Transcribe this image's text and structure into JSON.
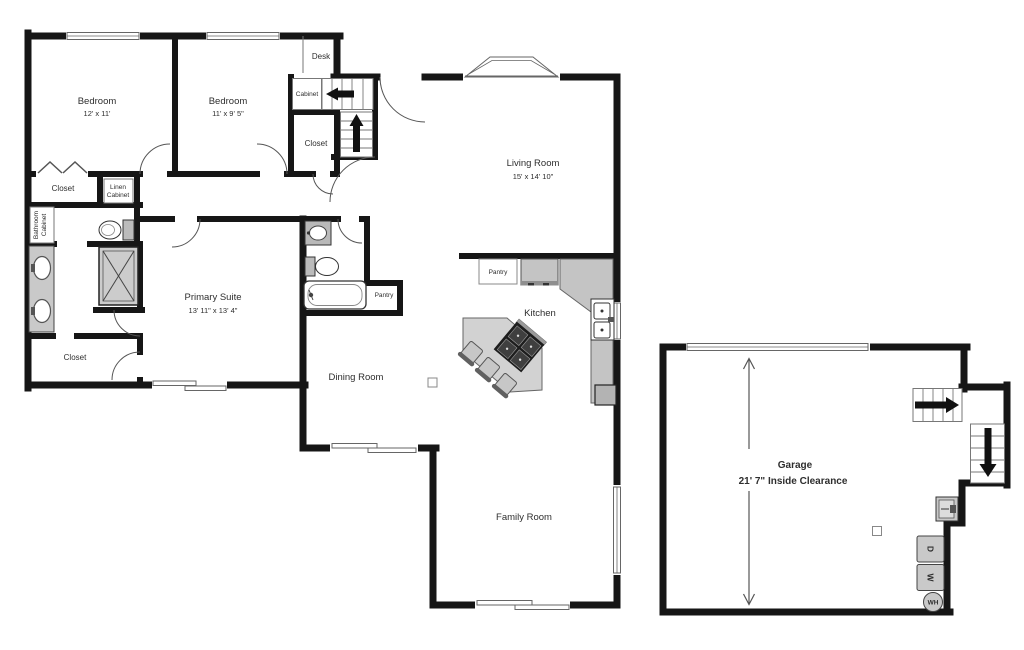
{
  "plan_title": "Single-story floor plan with garage",
  "rooms": {
    "bedroom1": {
      "name": "Bedroom",
      "dims": "12' x 11'"
    },
    "bedroom2": {
      "name": "Bedroom",
      "dims": "11' x 9' 5\""
    },
    "living_room": {
      "name": "Living Room",
      "dims": "15' x 14' 10\""
    },
    "primary_suite": {
      "name": "Primary Suite",
      "dims": "13' 11\" x 13' 4\""
    },
    "kitchen": {
      "name": "Kitchen"
    },
    "dining_room": {
      "name": "Dining Room"
    },
    "family_room": {
      "name": "Family Room"
    },
    "garage": {
      "name": "Garage",
      "dims": "21' 7\" Inside Clearance"
    }
  },
  "features": {
    "desk": "Desk",
    "cabinet": "Cabinet",
    "hall_closet": "Closet",
    "bedroom_closet": "Closet",
    "linen_cabinet_line1": "Linen",
    "linen_cabinet_line2": "Cabinet",
    "bathroom_cabinet_line1": "Bathroom",
    "bathroom_cabinet_line2": "Cabinet",
    "primary_closet": "Closet",
    "hall_pantry": "Pantry",
    "kitchen_pantry": "Pantry"
  },
  "appliances": {
    "dryer": "D",
    "washer": "W",
    "water_heater": "WH"
  },
  "colors": {
    "walls": "#161616",
    "thin_line": "#777777",
    "fixture_fill": "#c9c9c9",
    "island_fill": "#d2d2d2",
    "text": "#2e2e2e"
  }
}
